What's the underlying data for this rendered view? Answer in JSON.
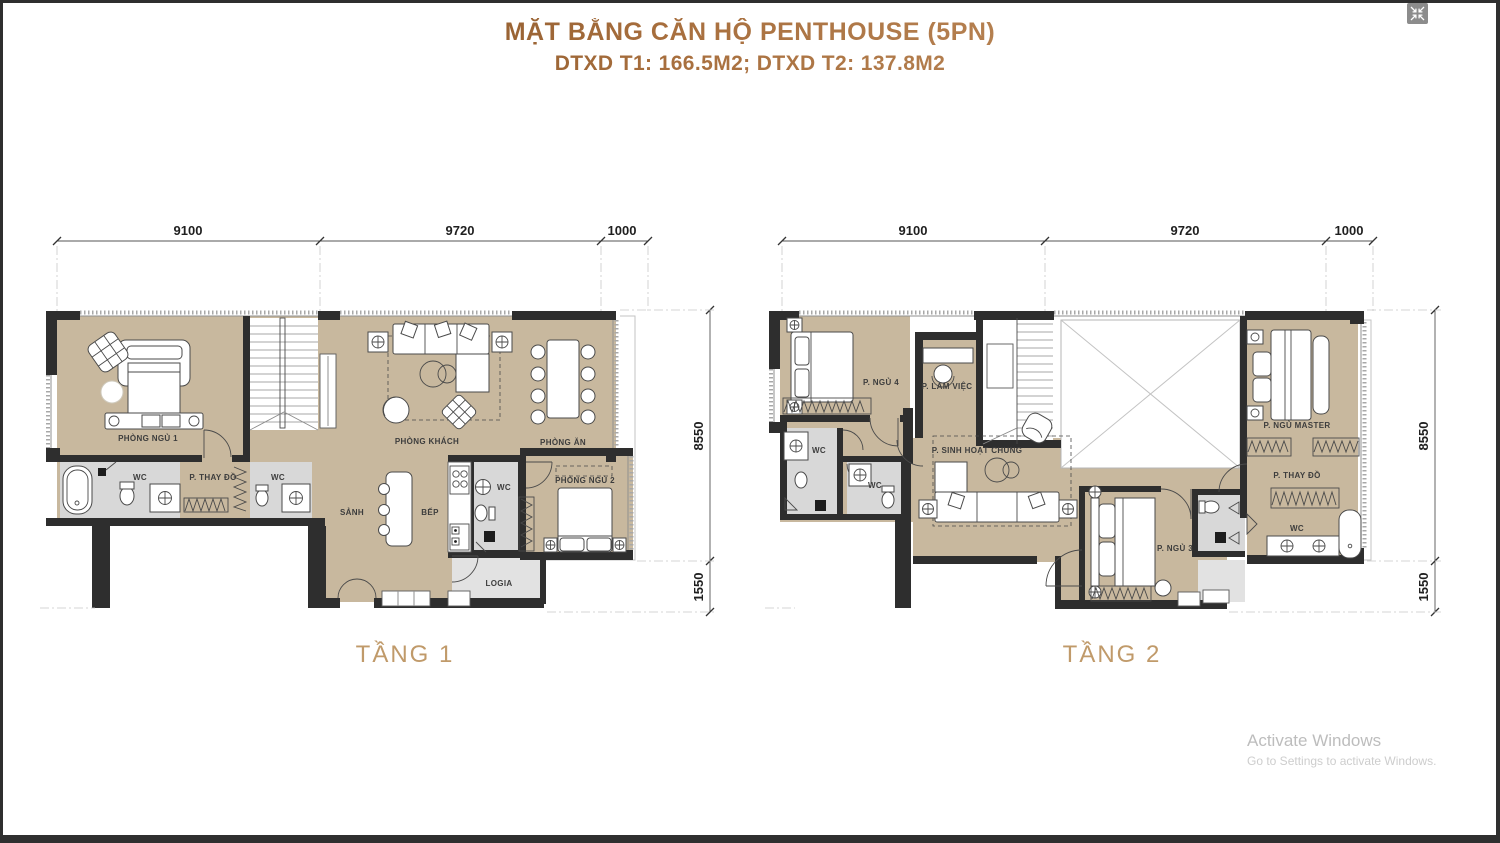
{
  "header": {
    "title": "MẶT BẰNG CĂN HỘ PENTHOUSE (5PN)",
    "subtitle": "DTXD T1: 166.5M2; DTXD T2: 137.8M2"
  },
  "floor1": {
    "label": "TẦNG 1",
    "dim_top": [
      "9100",
      "9720",
      "1000"
    ],
    "dim_right": [
      "8550",
      "1550"
    ],
    "rooms": {
      "bedroom1": "PHÒNG NGỦ 1",
      "wc_a": "WC",
      "dressing": "P. THAY ĐỒ",
      "wc_b": "WC",
      "living": "PHÒNG KHÁCH",
      "dining": "PHÒNG ĂN",
      "bedroom2": "PHÒNG NGỦ 2",
      "hall": "SẢNH",
      "kitchen": "BẾP",
      "wc_c": "WC",
      "logia": "LOGIA"
    }
  },
  "floor2": {
    "label": "TẦNG 2",
    "dim_top": [
      "9100",
      "9720",
      "1000"
    ],
    "dim_right": [
      "8550",
      "1550"
    ],
    "rooms": {
      "bedroom4": "P. NGỦ 4",
      "office": "P. LÀM VIỆC",
      "wc_a": "WC",
      "wc_b": "WC",
      "common_room": "P. SINH HOẠT CHUNG",
      "master": "P. NGỦ MASTER",
      "dressing": "P. THAY ĐỒ",
      "wc_c": "WC",
      "bedroom3": "P. NGỦ 3"
    }
  },
  "watermark": {
    "line1": "Activate Windows",
    "line2": "Go to Settings to activate Windows."
  },
  "colors": {
    "title_dark": "#6f4015",
    "title_light": "#c8996b",
    "floor_label": "#c09a6a",
    "floor_fill": "#c8b89e",
    "wet_fill": "#d8d8d8",
    "wall": "#2e2e2e"
  }
}
